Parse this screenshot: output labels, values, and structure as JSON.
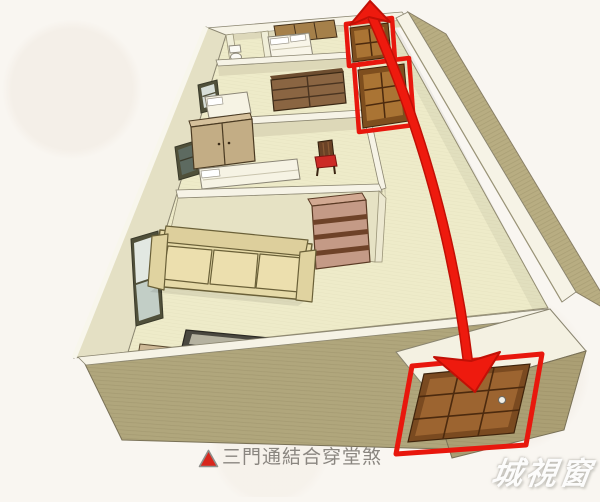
{
  "caption": {
    "marker": "▲",
    "text": "三門通結合穿堂煞"
  },
  "watermark": {
    "text": "城視窗"
  },
  "colors": {
    "background": "#f9f6f1",
    "arrow_red": "#ee1a0e",
    "door_outline_red": "#e8170d",
    "door_wood": "#a06b2c",
    "floor_cream": "#eeebc9",
    "exterior_wall_tan": "#b0a67c",
    "wall_top_white": "#f6f3e6",
    "caption_gray": "#8a8680",
    "triangle_red": "#d8261c",
    "watermark_white": "#ffffff"
  },
  "doors": [
    {
      "id": "back-door-top",
      "outlined": true
    },
    {
      "id": "corridor-door-middle",
      "outlined": true
    },
    {
      "id": "entrance-door-bottom",
      "outlined": true
    }
  ],
  "arrow": {
    "double_headed": true
  }
}
